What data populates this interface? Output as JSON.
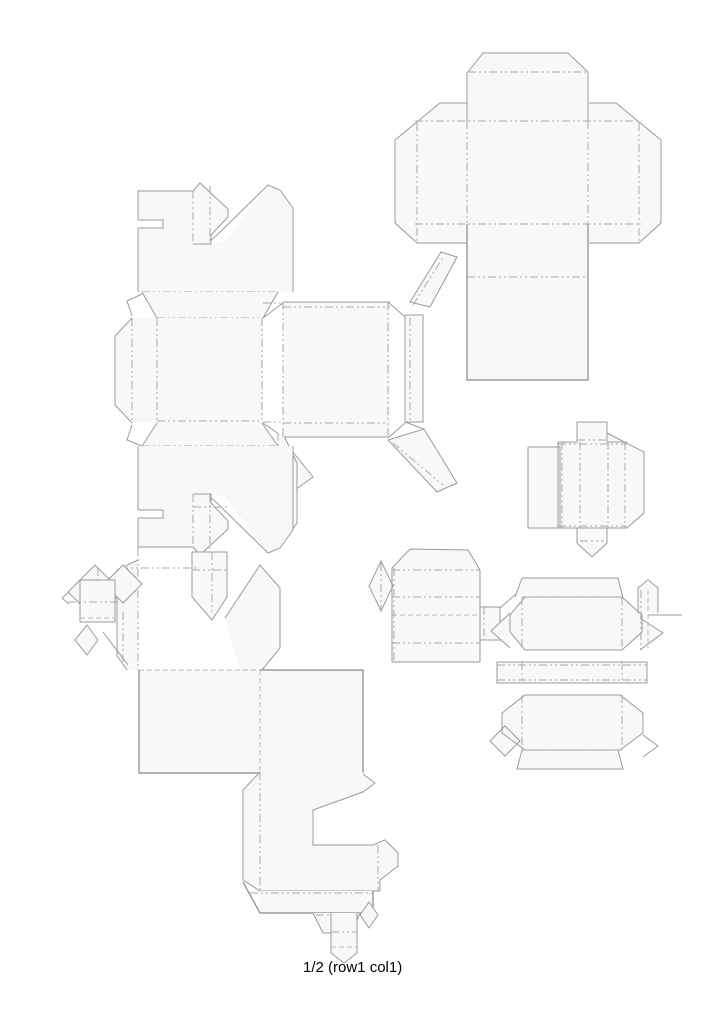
{
  "canvas": {
    "width": 724,
    "height": 1024,
    "background": "#ffffff"
  },
  "caption": {
    "text": "1/2 (row1 col1)"
  },
  "styles": {
    "f": {
      "fill": "#f8f8f8",
      "stroke": "none"
    },
    "w": {
      "fill": "#ffffff",
      "stroke": "none"
    },
    "c": {
      "fill": "none",
      "stroke": "#9b9b9b",
      "width": 1
    },
    "c2": {
      "fill": "none",
      "stroke": "#898989",
      "width": 1.2
    },
    "fo": {
      "fill": "none",
      "stroke": "#a9a9a9",
      "width": 1,
      "dash": "8 3 2 3 2 3"
    },
    "d": {
      "fill": "none",
      "stroke": "#b7b7b7",
      "width": 1,
      "dash": "5 3"
    }
  },
  "shapes": [
    {
      "name": "cross-box-dieline",
      "paths": [
        {
          "k": "f",
          "d": "M468,72 L483,53 L568,53 L588,72 Z"
        },
        {
          "k": "f",
          "d": "M467,72 H588 V380 H467 Z"
        },
        {
          "k": "f",
          "d": "M440,103 H467 V243 H417 L395,223 V140 Z"
        },
        {
          "k": "f",
          "d": "M616,103 H589 V243 H639 L661,223 V140 Z"
        },
        {
          "k": "c",
          "d": "M468,72 L483,53 L568,53 L588,72"
        },
        {
          "k": "c",
          "d": "M467,72 V121 M588,72 V121"
        },
        {
          "k": "c2",
          "d": "M467,224 V380 H588 V224"
        },
        {
          "k": "c",
          "d": "M467,103 H440 L395,140 V223 L417,243 H467"
        },
        {
          "k": "c",
          "d": "M589,103 H616 L661,140 V223 L639,243 H589"
        },
        {
          "k": "fo",
          "d": "M468,72 H588"
        },
        {
          "k": "fo",
          "d": "M415,121 H642"
        },
        {
          "k": "fo",
          "d": "M415,224 H642"
        },
        {
          "k": "fo",
          "d": "M467,121 V224 M588,121 V224"
        },
        {
          "k": "fo",
          "d": "M417,123 V242 M639,123 V242"
        },
        {
          "k": "fo",
          "d": "M467,277 H588"
        }
      ]
    },
    {
      "name": "crown-top-dieline",
      "paths": [
        {
          "k": "f",
          "d": "M138,191 L193,191 L200,183 L228,209 L228,217 L211,235 L211,244 L225,242 L268,185 L280,190 L293,208 L293,292 L138,292 Z"
        },
        {
          "k": "w",
          "d": "M138,220 H163 V228 H138 Z"
        },
        {
          "k": "c",
          "d": "M138,292 V228 M138,220 V191 H193 L200,183 L228,209 V217 L211,235 V244 H193"
        },
        {
          "k": "c",
          "d": "M138,220 H163 V228 H138"
        },
        {
          "k": "c",
          "d": "M211,240 L215,237 L268,185 L280,190 L293,208 V292"
        },
        {
          "k": "fo",
          "d": "M193,191 V244 M210,186 V244"
        },
        {
          "k": "fo",
          "d": "M142,292 H278"
        }
      ]
    },
    {
      "name": "fold-band-top",
      "paths": [
        {
          "k": "f",
          "d": "M142,292 L278,292 L263,318 L157,318 Z"
        },
        {
          "k": "c",
          "d": "M142,292 L157,318 M278,292 L263,318"
        },
        {
          "k": "fo",
          "d": "M157,318 H263"
        }
      ]
    },
    {
      "name": "square-panel-dieline",
      "paths": [
        {
          "k": "f",
          "d": "M132,318 H263 V423 H132 Z"
        },
        {
          "k": "f",
          "d": "M132,318 L115,336 V405 L132,423 Z"
        },
        {
          "k": "c",
          "d": "M132,318 L115,336 V405 L132,423"
        },
        {
          "k": "c",
          "d": "M142,294 L127,301 L132,316 M132,425 L127,440 L142,446"
        },
        {
          "k": "c",
          "d": "M263,318 L283,303 M263,423 L283,437"
        },
        {
          "k": "fo",
          "d": "M132,318 V423 M157,318 V423 M262,318 V423"
        },
        {
          "k": "fo",
          "d": "M157,421 H262"
        },
        {
          "k": "fo",
          "d": "M263,303 H283 M263,422 H283"
        }
      ]
    },
    {
      "name": "fold-band-bottom",
      "paths": [
        {
          "k": "f",
          "d": "M157,423 L262,423 L278,446 L142,446 Z"
        },
        {
          "k": "c",
          "d": "M157,423 L142,446 M262,423 L278,446"
        },
        {
          "k": "fo",
          "d": "M142,446 H278"
        }
      ]
    },
    {
      "name": "rect-panel-dieline",
      "paths": [
        {
          "k": "f",
          "d": "M283,302 H390 V437 H283 Z"
        },
        {
          "k": "f",
          "d": "M405,315 H423 V422 H405 Z"
        },
        {
          "k": "f",
          "d": "M410,302 L441,252 L457,257 L430,307 Z"
        },
        {
          "k": "f",
          "d": "M388,440 L424,429 L457,483 L437,492 Z"
        },
        {
          "k": "f",
          "d": "M285,442 L313,477 L295,490 Z"
        },
        {
          "k": "c",
          "d": "M283,302 H390 M283,437 H388"
        },
        {
          "k": "c",
          "d": "M405,315 H423 V422 H405 V315"
        },
        {
          "k": "c",
          "d": "M388,302 L405,317 M388,438 L405,423 M405,422 L424,429"
        },
        {
          "k": "c",
          "d": "M410,302 L441,252 L457,257 L430,307 Z"
        },
        {
          "k": "c",
          "d": "M388,440 L424,429 L457,483 L437,492 Z"
        },
        {
          "k": "c",
          "d": "M285,442 L313,477 L295,490"
        },
        {
          "k": "fo",
          "d": "M283,307 H390"
        },
        {
          "k": "fo",
          "d": "M283,302 V437 M388,302 V437"
        },
        {
          "k": "fo",
          "d": "M283,423 H388"
        },
        {
          "k": "fo",
          "d": "M413,305 L444,256"
        },
        {
          "k": "fo",
          "d": "M393,443 L443,485"
        },
        {
          "k": "fo",
          "d": "M410,318 V422"
        }
      ]
    },
    {
      "name": "side-strip-dieline",
      "paths": [
        {
          "k": "f",
          "d": "M278,433 L285,438 L297,463 V523 L280,548 L278,543 Z"
        },
        {
          "k": "c",
          "d": "M285,438 L297,463 V523 L280,548"
        },
        {
          "k": "fo",
          "d": "M278,433 V543"
        }
      ]
    },
    {
      "name": "crown-bottom-dieline",
      "paths": [
        {
          "k": "f",
          "d": "M138,446 L138,547 L193,547 L200,555 L228,529 L228,521 L211,503 L211,494 L225,496 L268,553 L280,548 L293,530 L293,446 Z"
        },
        {
          "k": "w",
          "d": "M138,510 H163 V518 H138 Z"
        },
        {
          "k": "c",
          "d": "M138,446 V510 M138,518 V547 H193 L200,555 L228,529 V521 L211,503 V494 H193"
        },
        {
          "k": "c",
          "d": "M138,510 H163 V518 H138"
        },
        {
          "k": "c",
          "d": "M211,498 L215,501 L268,553 L280,548 L293,530 V446"
        },
        {
          "k": "fo",
          "d": "M193,494 V547 M210,494 V550"
        },
        {
          "k": "fo",
          "d": "M193,507 H227"
        }
      ]
    },
    {
      "name": "crown-bottom-extension",
      "paths": [
        {
          "k": "f",
          "d": "M192,552 H227 V597 L212,620 L192,597 Z"
        },
        {
          "k": "c",
          "d": "M192,552 V597 L212,620 L227,597 V552 H192"
        },
        {
          "k": "fo",
          "d": "M192,570 H227 M212,552 V615"
        },
        {
          "k": "f",
          "d": "M225,618 L260,565 L280,588 V648 L262,670 H240 Z"
        },
        {
          "k": "c",
          "d": "M225,618 L260,565 L280,588 V648 L262,670"
        },
        {
          "k": "f",
          "d": "M117,570 L138,560 V670 L127,670 L117,656 Z"
        },
        {
          "k": "c",
          "d": "M138,560 L117,570 V656 L127,670"
        },
        {
          "k": "fo",
          "d": "M138,548 V670"
        },
        {
          "k": "fo",
          "d": "M120,568 H197"
        }
      ]
    },
    {
      "name": "large-squares-dieline",
      "paths": [
        {
          "k": "f",
          "d": "M139,670 H260 V773 H139 Z"
        },
        {
          "k": "f",
          "d": "M260,670 H363 V773 H260 Z"
        },
        {
          "k": "c2",
          "d": "M139,670 V773 H260"
        },
        {
          "k": "c2",
          "d": "M260,670 H363 V773"
        },
        {
          "k": "d",
          "d": "M139,670 H260 M260,670 V773 M260,773 H363"
        }
      ]
    },
    {
      "name": "c-shape-dieline",
      "paths": [
        {
          "k": "f",
          "d": "M260,772 H363 V774 L375,783 L363,792 L313,810 V845 H373 L385,840 L398,853 V866 L380,880 V891 H260 L243,880 V790 Z"
        },
        {
          "k": "c",
          "d": "M363,774 L375,783 L363,792 L313,810 V845 H373"
        },
        {
          "k": "c",
          "d": "M373,845 L385,840 L398,853 V866 L380,880 V891 H260 L243,880 V790 L260,772"
        },
        {
          "k": "fo",
          "d": "M260,772 V891"
        },
        {
          "k": "fo",
          "d": "M378,845 V891"
        }
      ]
    },
    {
      "name": "bottom-strip-dieline",
      "paths": [
        {
          "k": "f",
          "d": "M260,891 H373 V913 H260 Z"
        },
        {
          "k": "c2",
          "d": "M373,891 V913 H260 L243,882"
        },
        {
          "k": "fo",
          "d": "M250,893 H373"
        }
      ]
    },
    {
      "name": "bottom-tabs-dieline",
      "paths": [
        {
          "k": "f",
          "d": "M313,913 L360,913 L352,933 L323,933 Z"
        },
        {
          "k": "c",
          "d": "M313,913 L323,933 H352 L360,913"
        },
        {
          "k": "fo",
          "d": "M316,915 H357"
        },
        {
          "k": "f",
          "d": "M369,902 L378,915 L369,928 L360,915 Z"
        },
        {
          "k": "c",
          "d": "M369,902 L378,915 L369,928 L360,915 Z"
        },
        {
          "k": "f",
          "d": "M331,913 H357 V953 L344,963 L331,953 Z"
        },
        {
          "k": "c",
          "d": "M331,913 V953 L344,963 L357,953 V913"
        },
        {
          "k": "fo",
          "d": "M331,932 H357"
        },
        {
          "k": "d",
          "d": "M331,947 H357"
        }
      ]
    },
    {
      "name": "diamond-cluster-dieline",
      "paths": [
        {
          "k": "f",
          "d": "M95,565 L122,592 L95,619 L68,592 Z"
        },
        {
          "k": "c",
          "d": "M95,565 L122,592 L95,619 L68,592 Z"
        },
        {
          "k": "f",
          "d": "M123,565 L142,584 L123,603 L104,584 Z"
        },
        {
          "k": "c",
          "d": "M123,565 L142,584 L123,603 L104,584 Z"
        },
        {
          "k": "f",
          "d": "M87,625 L98,640 L87,655 L75,640 Z"
        },
        {
          "k": "c",
          "d": "M87,625 L98,640 L87,655 L75,640 Z"
        },
        {
          "k": "f",
          "d": "M80,580 H115 V622 H80 Z"
        },
        {
          "k": "c",
          "d": "M80,580 H115 V622 H80 V580"
        },
        {
          "k": "fo",
          "d": "M68,602 H118"
        },
        {
          "k": "d",
          "d": "M80,618 H115"
        },
        {
          "k": "fo",
          "d": "M98,568 V583"
        },
        {
          "k": "c",
          "d": "M62,598 L69,592 M62,598 L69,604"
        },
        {
          "k": "c",
          "d": "M103,632 L128,665"
        },
        {
          "k": "fo",
          "d": "M123,612 V665"
        }
      ]
    },
    {
      "name": "striped-box-dieline",
      "paths": [
        {
          "k": "f",
          "d": "M392,568 H480 V662 H392 Z"
        },
        {
          "k": "f",
          "d": "M392,568 L410,549 L468,550 L480,570 Z"
        },
        {
          "k": "f",
          "d": "M381,561 L393,586 L381,611 L369,586 Z"
        },
        {
          "k": "f",
          "d": "M480,607 H500 V640 H480 Z"
        },
        {
          "k": "c",
          "d": "M392,568 L410,549 L468,550 L480,570"
        },
        {
          "k": "c",
          "d": "M392,568 V662 H480 V570"
        },
        {
          "k": "c",
          "d": "M381,561 L393,586 L381,611 L369,586 Z"
        },
        {
          "k": "c",
          "d": "M480,607 H500 V640 H480"
        },
        {
          "k": "c",
          "d": "M500,608 L532,580"
        },
        {
          "k": "fo",
          "d": "M392,570 H480 M392,597 H480 M392,643 H480"
        },
        {
          "k": "d",
          "d": "M392,615 H480"
        },
        {
          "k": "fo",
          "d": "M394,568 V662"
        },
        {
          "k": "fo",
          "d": "M484,607 V640"
        },
        {
          "k": "fo",
          "d": "M381,563 V609"
        }
      ]
    },
    {
      "name": "octagon-stack-dieline",
      "paths": [
        {
          "k": "f",
          "d": "M515,597 L522,578 H618 L623,598 Z"
        },
        {
          "k": "f",
          "d": "M525,597 H622 L642,615 V632 L622,650 H525 L510,632 V615 Z"
        },
        {
          "k": "f",
          "d": "M497,662 H647 V683 H497 Z"
        },
        {
          "k": "f",
          "d": "M525,695 H620 L643,713 V733 L620,750 H525 L502,733 V713 Z"
        },
        {
          "k": "f",
          "d": "M517,769 L522,750 H618 L623,769 Z"
        },
        {
          "k": "f",
          "d": "M638,588 L648,580 L658,588 V613 H638 Z"
        },
        {
          "k": "f",
          "d": "M640,618 L663,633 L640,650 Z"
        },
        {
          "k": "f",
          "d": "M510,613 L491,631 L510,648 Z"
        },
        {
          "k": "f",
          "d": "M505,726 L520,741 L505,756 L490,741 Z"
        },
        {
          "k": "c",
          "d": "M515,597 L522,578 H618 L623,598"
        },
        {
          "k": "c",
          "d": "M525,597 H622 L642,615 V632 L622,650 H525 L510,632 V615 Z"
        },
        {
          "k": "c",
          "d": "M497,662 H647 V683 H497 Z"
        },
        {
          "k": "c",
          "d": "M525,695 H620 L643,713 V733 L620,750 H525 L502,733 V713 Z"
        },
        {
          "k": "c",
          "d": "M517,769 L522,750 H618 L623,769 Z"
        },
        {
          "k": "c",
          "d": "M638,613 V588 L648,580 L658,588 V613"
        },
        {
          "k": "c",
          "d": "M640,618 L663,633 L640,650"
        },
        {
          "k": "c",
          "d": "M510,613 L491,631 L510,648"
        },
        {
          "k": "c",
          "d": "M505,726 L520,741 L505,756 L490,741 Z"
        },
        {
          "k": "c",
          "d": "M648,615 H682"
        },
        {
          "k": "c",
          "d": "M643,735 L658,746 L643,757"
        },
        {
          "k": "fo",
          "d": "M522,597 H622"
        },
        {
          "k": "fo",
          "d": "M497,665 H647 M497,680 H647"
        },
        {
          "k": "fo",
          "d": "M522,662 V683 M622,662 V683"
        },
        {
          "k": "fo",
          "d": "M522,597 V650 M622,597 V650"
        },
        {
          "k": "fo",
          "d": "M522,695 V750 M622,695 V750"
        },
        {
          "k": "fo",
          "d": "M522,750 H618"
        },
        {
          "k": "fo",
          "d": "M641,590 V650"
        },
        {
          "k": "d",
          "d": "M648,590 V648"
        }
      ]
    },
    {
      "name": "small-box-dieline",
      "paths": [
        {
          "k": "f",
          "d": "M528,447 H560 V528 H528 Z"
        },
        {
          "k": "f",
          "d": "M558,442 H627 V528 H558 Z"
        },
        {
          "k": "f",
          "d": "M577,422 H607 V442 H577 Z"
        },
        {
          "k": "f",
          "d": "M607,433 L644,452 V513 L627,528 H607 Z"
        },
        {
          "k": "f",
          "d": "M577,528 H607 V543 L592,557 L577,543 Z"
        },
        {
          "k": "c",
          "d": "M528,447 H560 V528 H528 V447"
        },
        {
          "k": "c",
          "d": "M577,442 V422 H607 V442"
        },
        {
          "k": "c",
          "d": "M558,442 H577 M607,442 H627 M558,442 V528 M558,528 H627"
        },
        {
          "k": "c",
          "d": "M607,433 L644,452 V513 L627,528"
        },
        {
          "k": "c",
          "d": "M577,528 V543 L592,557 L607,543 V528"
        },
        {
          "k": "fo",
          "d": "M562,442 V528 M580,442 V528 M608,442 V528 M625,442 V528"
        },
        {
          "k": "fo",
          "d": "M558,444 H627 M558,526 H627"
        },
        {
          "k": "fo",
          "d": "M577,440 H607"
        },
        {
          "k": "fo",
          "d": "M580,541 H604"
        }
      ]
    }
  ]
}
